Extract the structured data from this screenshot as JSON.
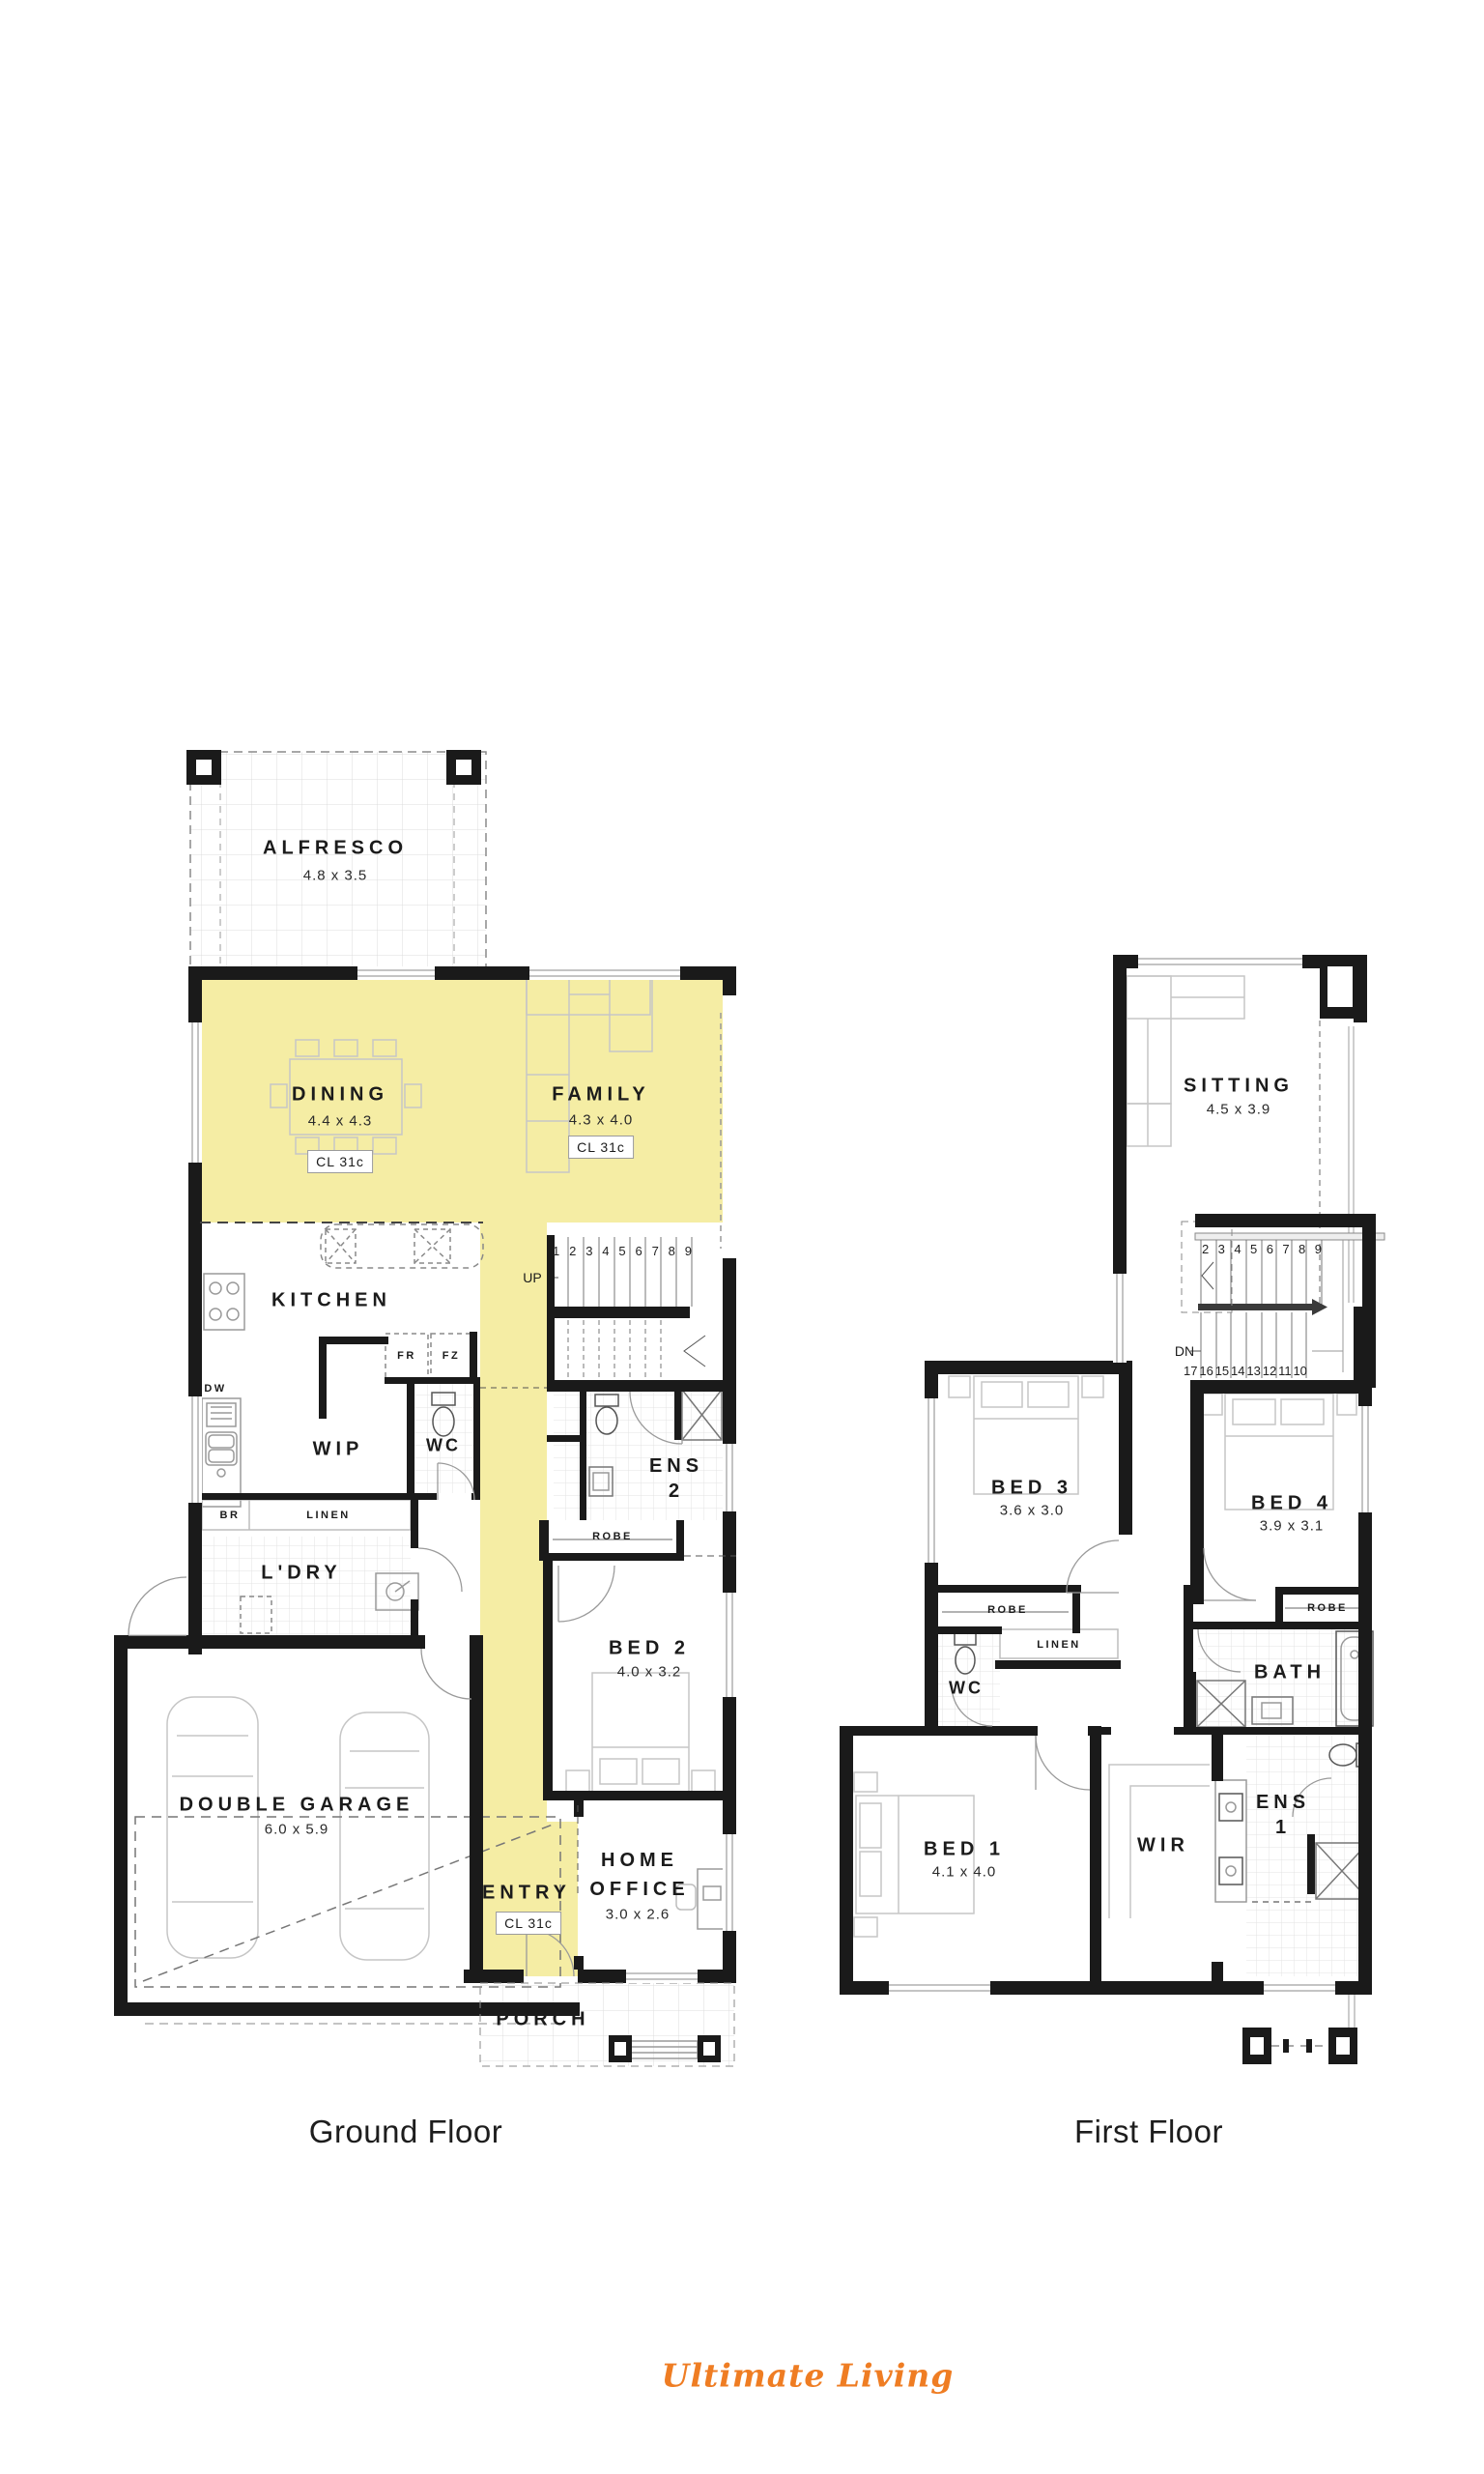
{
  "branding": {
    "logo_text": "Ultimate Living",
    "logo_color": "#EF7D23"
  },
  "colors": {
    "highlight": "#F5EDA4",
    "wall": "#1A1A1A"
  },
  "floors": {
    "ground": {
      "caption": "Ground Floor",
      "rooms": {
        "alfresco": {
          "name": "ALFRESCO",
          "dims": "4.8 x 3.5"
        },
        "dining": {
          "name": "DINING",
          "dims": "4.4 x 4.3",
          "ceiling": "CL 31c"
        },
        "family": {
          "name": "FAMILY",
          "dims": "4.3 x 4.0",
          "ceiling": "CL 31c"
        },
        "kitchen": {
          "name": "KITCHEN"
        },
        "wip": {
          "name": "WIP"
        },
        "wc": {
          "name": "WC"
        },
        "ens2": {
          "name": "ENS",
          "number": "2"
        },
        "ldry": {
          "name": "L'DRY"
        },
        "bed2": {
          "name": "BED 2",
          "dims": "4.0 x 3.2"
        },
        "garage": {
          "name": "DOUBLE GARAGE",
          "dims": "6.0 x 5.9"
        },
        "entry": {
          "name": "ENTRY",
          "ceiling": "CL 31c"
        },
        "home_office": {
          "name": "HOME OFFICE",
          "dims": "3.0 x 2.6"
        },
        "porch": {
          "name": "PORCH"
        }
      },
      "fixtures": {
        "dw": "DW",
        "fr": "FR",
        "fz": "FZ",
        "br": "BR",
        "linen": "LINEN",
        "robe": "ROBE"
      },
      "stairs": {
        "direction": "UP",
        "numbers": [
          "1",
          "2",
          "3",
          "4",
          "5",
          "6",
          "7",
          "8",
          "9"
        ]
      }
    },
    "first": {
      "caption": "First Floor",
      "rooms": {
        "sitting": {
          "name": "SITTING",
          "dims": "4.5 x 3.9"
        },
        "bed3": {
          "name": "BED 3",
          "dims": "3.6 x 3.0"
        },
        "bed4": {
          "name": "BED 4",
          "dims": "3.9 x 3.1"
        },
        "wc": {
          "name": "WC"
        },
        "bath": {
          "name": "BATH"
        },
        "bed1": {
          "name": "BED 1",
          "dims": "4.1 x 4.0"
        },
        "wir": {
          "name": "WIR"
        },
        "ens1": {
          "name": "ENS",
          "number": "1"
        }
      },
      "fixtures": {
        "robe3": "ROBE",
        "linen": "LINEN",
        "robe4": "ROBE"
      },
      "stairs": {
        "direction": "DN",
        "numbers_top": [
          "2",
          "3",
          "4",
          "5",
          "6",
          "7",
          "8",
          "9"
        ],
        "numbers_bottom": [
          "17",
          "16",
          "15",
          "14",
          "13",
          "12",
          "11",
          "10"
        ]
      }
    }
  }
}
